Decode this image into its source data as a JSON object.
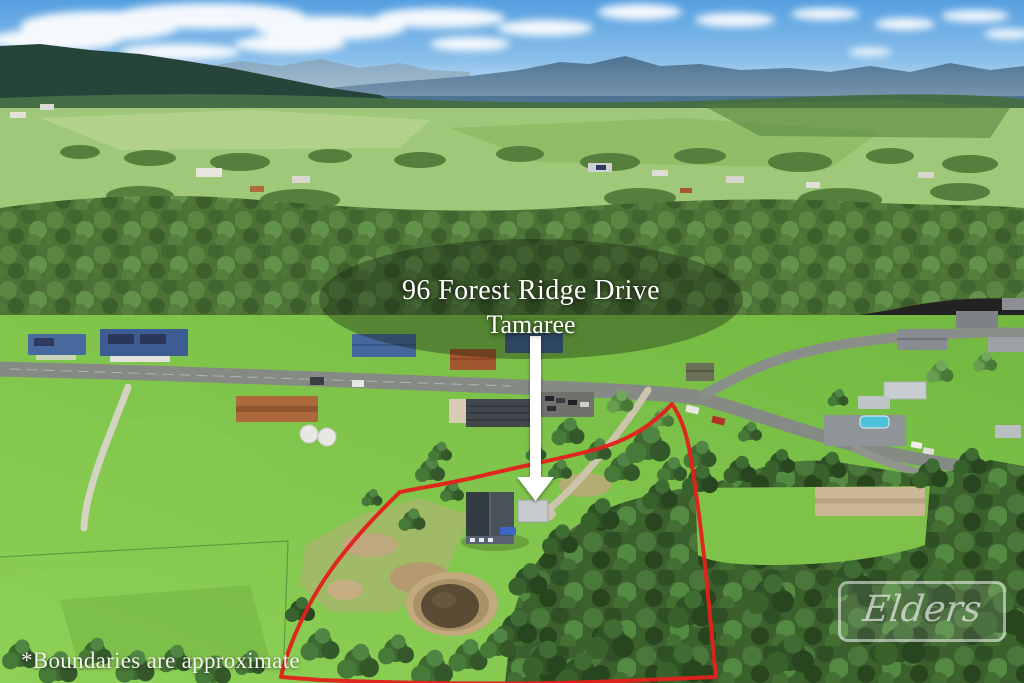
{
  "overlay": {
    "address_line1": "96 Forest Ridge Drive",
    "address_line2": "Tamaree",
    "disclaimer": "*Boundaries are approximate",
    "boundary_color": "#E2211C",
    "arrow_color": "#FFFFFF"
  },
  "watermark": {
    "brand": "Elders"
  }
}
